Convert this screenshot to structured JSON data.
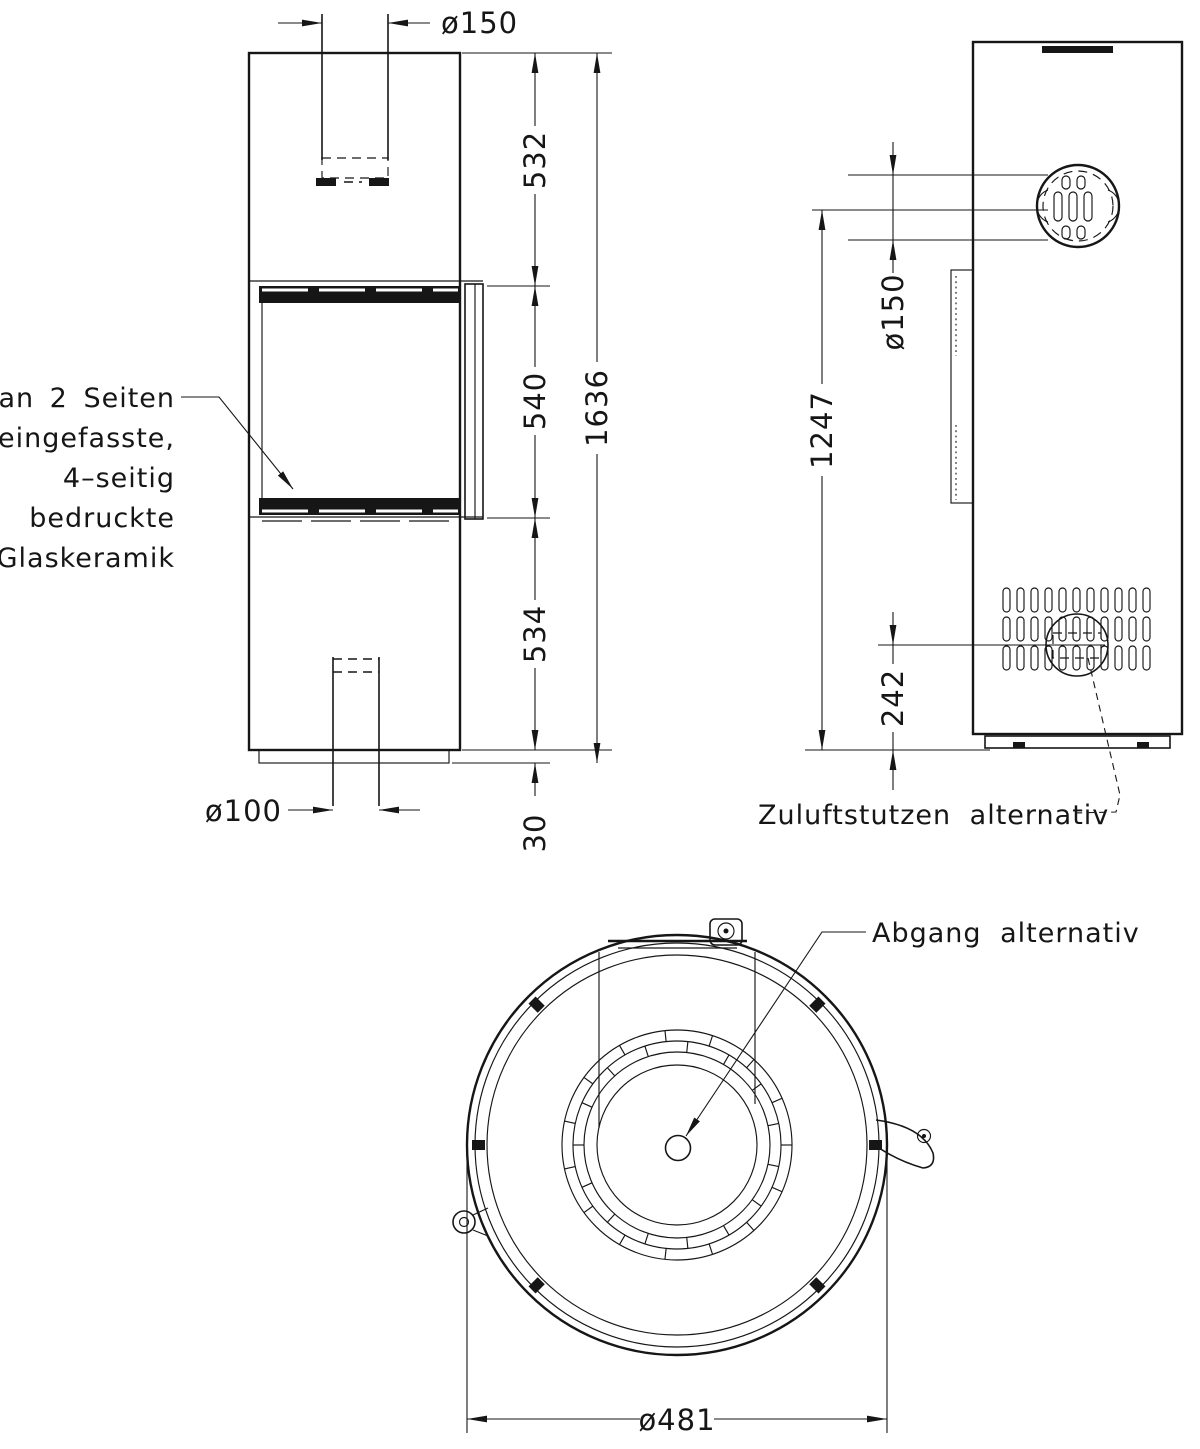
{
  "glass_note": {
    "lines": [
      "an 2 Seiten",
      "eingefasste,",
      "4–seitig",
      "bedruckte",
      "Glaskeramik"
    ]
  },
  "front_view": {
    "flue_diameter": "ø150",
    "top_section_height": "532",
    "glass_section_height": "540",
    "bottom_section_height": "534",
    "total_height": "1636",
    "base_height": "30",
    "air_inlet_diameter": "ø100"
  },
  "side_view": {
    "flue_center_height": "1247",
    "flue_diameter": "ø150",
    "air_inlet_center_height": "242",
    "air_inlet_label": "Zuluftstutzen alternativ"
  },
  "top_view": {
    "outlet_label": "Abgang alternativ",
    "outer_diameter": "ø481"
  },
  "colors": {
    "ink": "#161616",
    "background": "#ffffff"
  }
}
